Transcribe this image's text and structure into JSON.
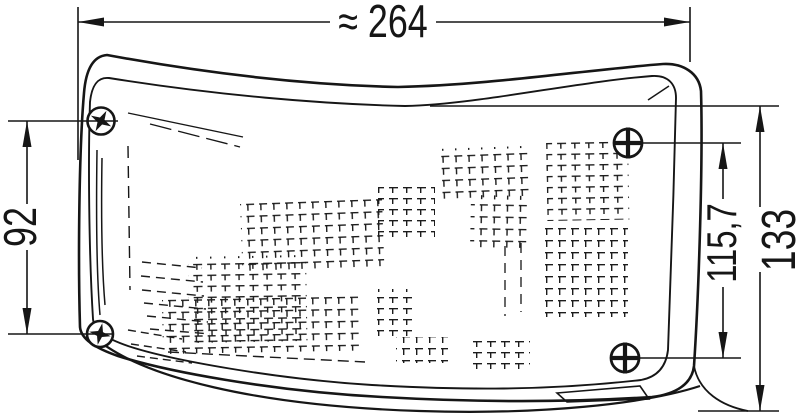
{
  "page": {
    "background": "#ffffff",
    "ink": "#161616"
  },
  "drawing": {
    "type": "technical-dimension-drawing",
    "subject": "wraparound vehicle signal lamp, front view, four mounting screws, fresnel lens texture",
    "dimension_labels": {
      "overall_width": "≈ 264",
      "left_screw_spacing": "92",
      "right_screw_spacing": "115,7",
      "overall_height": "133"
    }
  }
}
